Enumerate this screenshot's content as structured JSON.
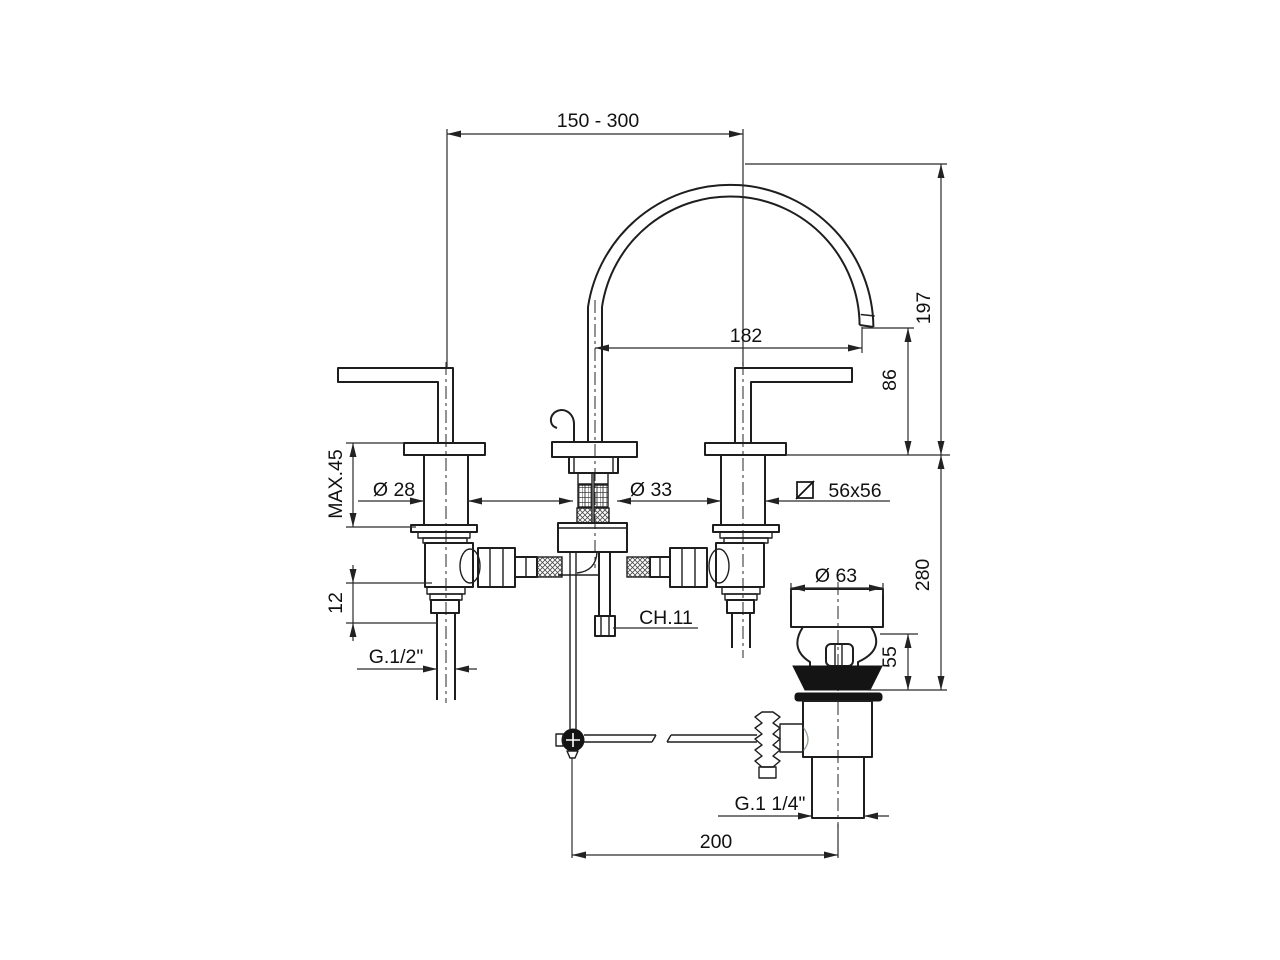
{
  "drawing": {
    "type": "technical-dimension-drawing",
    "subject": "3-hole basin mixer tap with swan-neck spout and pop-up waste",
    "background_color": "#ffffff",
    "line_color": "#1e1e1e",
    "dimensions": {
      "handle_span_range": "150 - 300",
      "spout_reach": "182",
      "spout_height": "197",
      "outlet_height": "86",
      "max_deck_thickness": "MAX.45",
      "handle_diameter": "Ø 28",
      "spout_column_diameter": "Ø 33",
      "base_square": "56x56",
      "inlet_offset": "12",
      "below_deck_depth": "280",
      "drain_flange_diameter": "Ø 63",
      "drain_body_height": "55",
      "drain_horizontal_offset": "200"
    },
    "labels": {
      "inlet_thread": "G.1/2\"",
      "rod_hex_size": "CH.11",
      "drain_thread": "G.1 1/4\""
    },
    "icons": {
      "square_section_symbol": "square-with-diagonal"
    }
  }
}
